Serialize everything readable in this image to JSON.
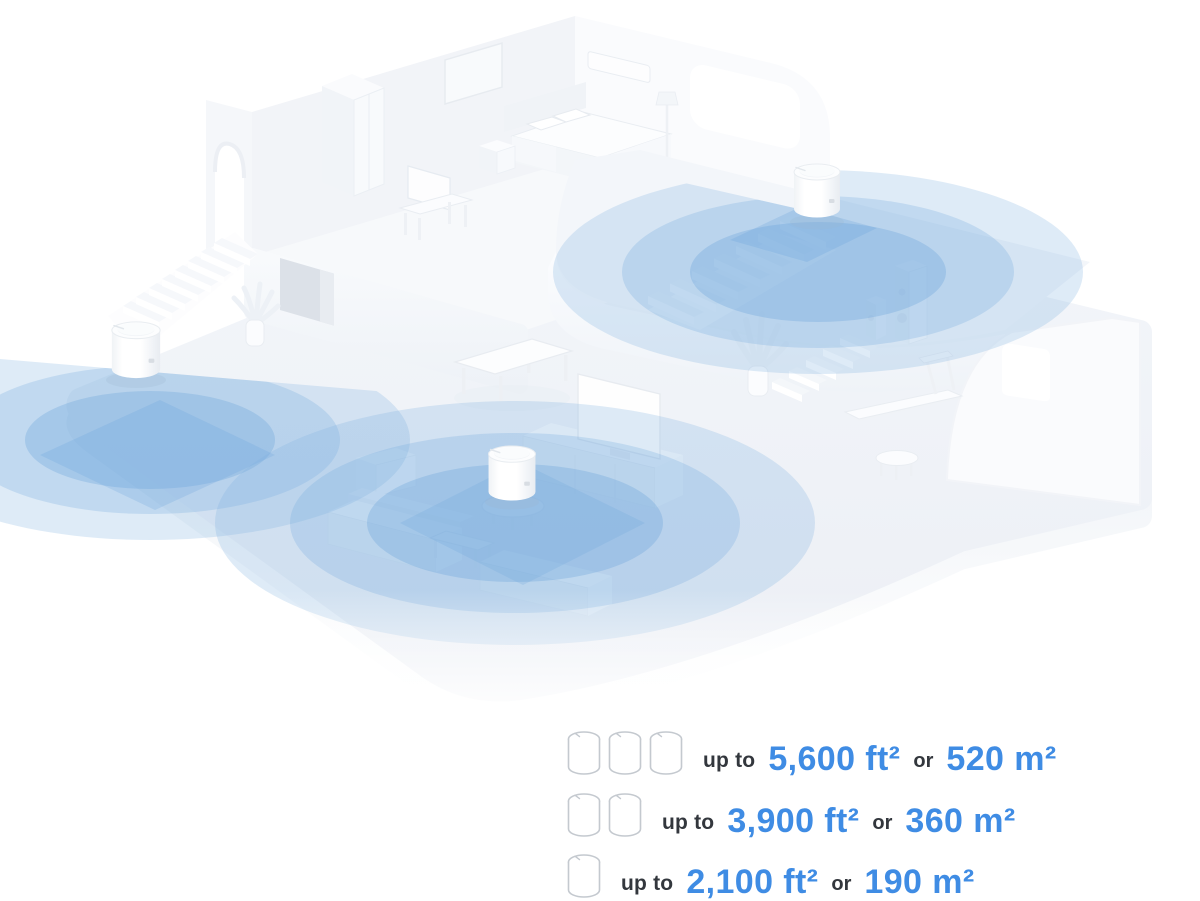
{
  "scene": {
    "unit_count": 3,
    "coverage_ring_color": "#7fb3e2",
    "house_base_color": "#eff3f8"
  },
  "legend": {
    "accent_color": "#3f8ce4",
    "text_color": "#33373d",
    "rows": [
      {
        "unit_count": 3,
        "prefix": "up to",
        "imperial": "5,600 ft²",
        "conjunction": "or",
        "metric": "520 m²"
      },
      {
        "unit_count": 2,
        "prefix": "up to",
        "imperial": "3,900 ft²",
        "conjunction": "or",
        "metric": "360 m²"
      },
      {
        "unit_count": 1,
        "prefix": "up to",
        "imperial": "2,100 ft²",
        "conjunction": "or",
        "metric": "190 m²"
      }
    ]
  }
}
